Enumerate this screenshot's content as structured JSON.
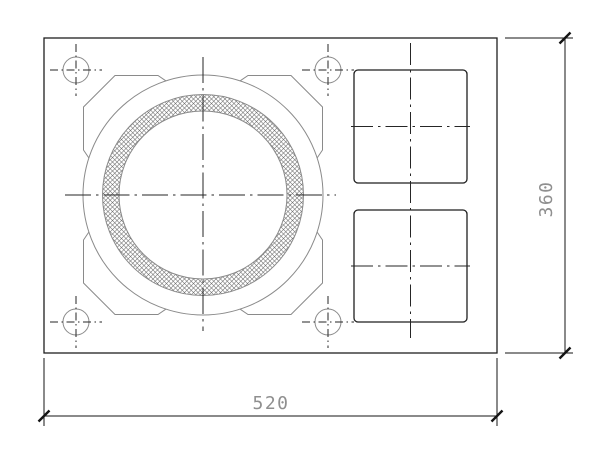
{
  "drawing": {
    "dimension_width": {
      "label": "520"
    },
    "dimension_height": {
      "label": "360"
    }
  },
  "colors": {
    "background": "#ffffff",
    "object-line": "#1f1f1f",
    "thin-line": "#8a8a8a",
    "center-line": "#262626",
    "dimension-line": "#141414",
    "dimension-text": "#8f8f8f",
    "hatch-line": "#6f6f6f"
  }
}
